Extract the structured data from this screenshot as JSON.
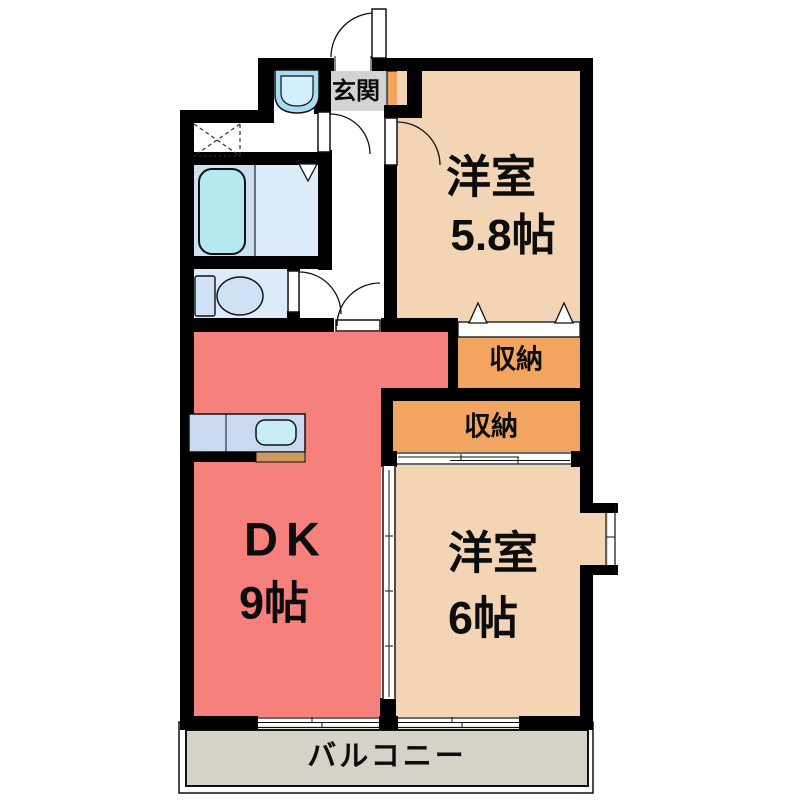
{
  "plan": {
    "rooms": {
      "entrance": {
        "label": "玄関"
      },
      "western_room_1": {
        "label": "洋室",
        "size": "5.8帖"
      },
      "storage_1": {
        "label": "収納"
      },
      "storage_2": {
        "label": "収納"
      },
      "dining_kitchen": {
        "label": "DK",
        "size": "9帖"
      },
      "western_room_2": {
        "label": "洋室",
        "size": "6帖"
      },
      "balcony": {
        "label": "バルコニー"
      }
    },
    "colors": {
      "wall": "#000000",
      "dk_fill": "#f5807c",
      "room_fill": "#f3d4b5",
      "storage_fill": "#f1a560",
      "entrance_fill": "#d3d3d3",
      "shoebox_fill": "#f2a55f",
      "balcony_fill": "#d7d2c8",
      "bath_left_fill": "#cfdff2",
      "bath_right_fill": "#dcebf8",
      "toilet_room_fill": "#dcebf8",
      "bathtub_fill": "#b5e9f2",
      "basin_outer_fill": "#a9dcf2",
      "basin_inner_fill": "#d2f0fb",
      "toilet_fill": "#cfe2f6",
      "counter_fill": "#c9d9f2",
      "sink_fill": "#c6edf6",
      "counter_edge_fill": "#cc9a60"
    }
  }
}
